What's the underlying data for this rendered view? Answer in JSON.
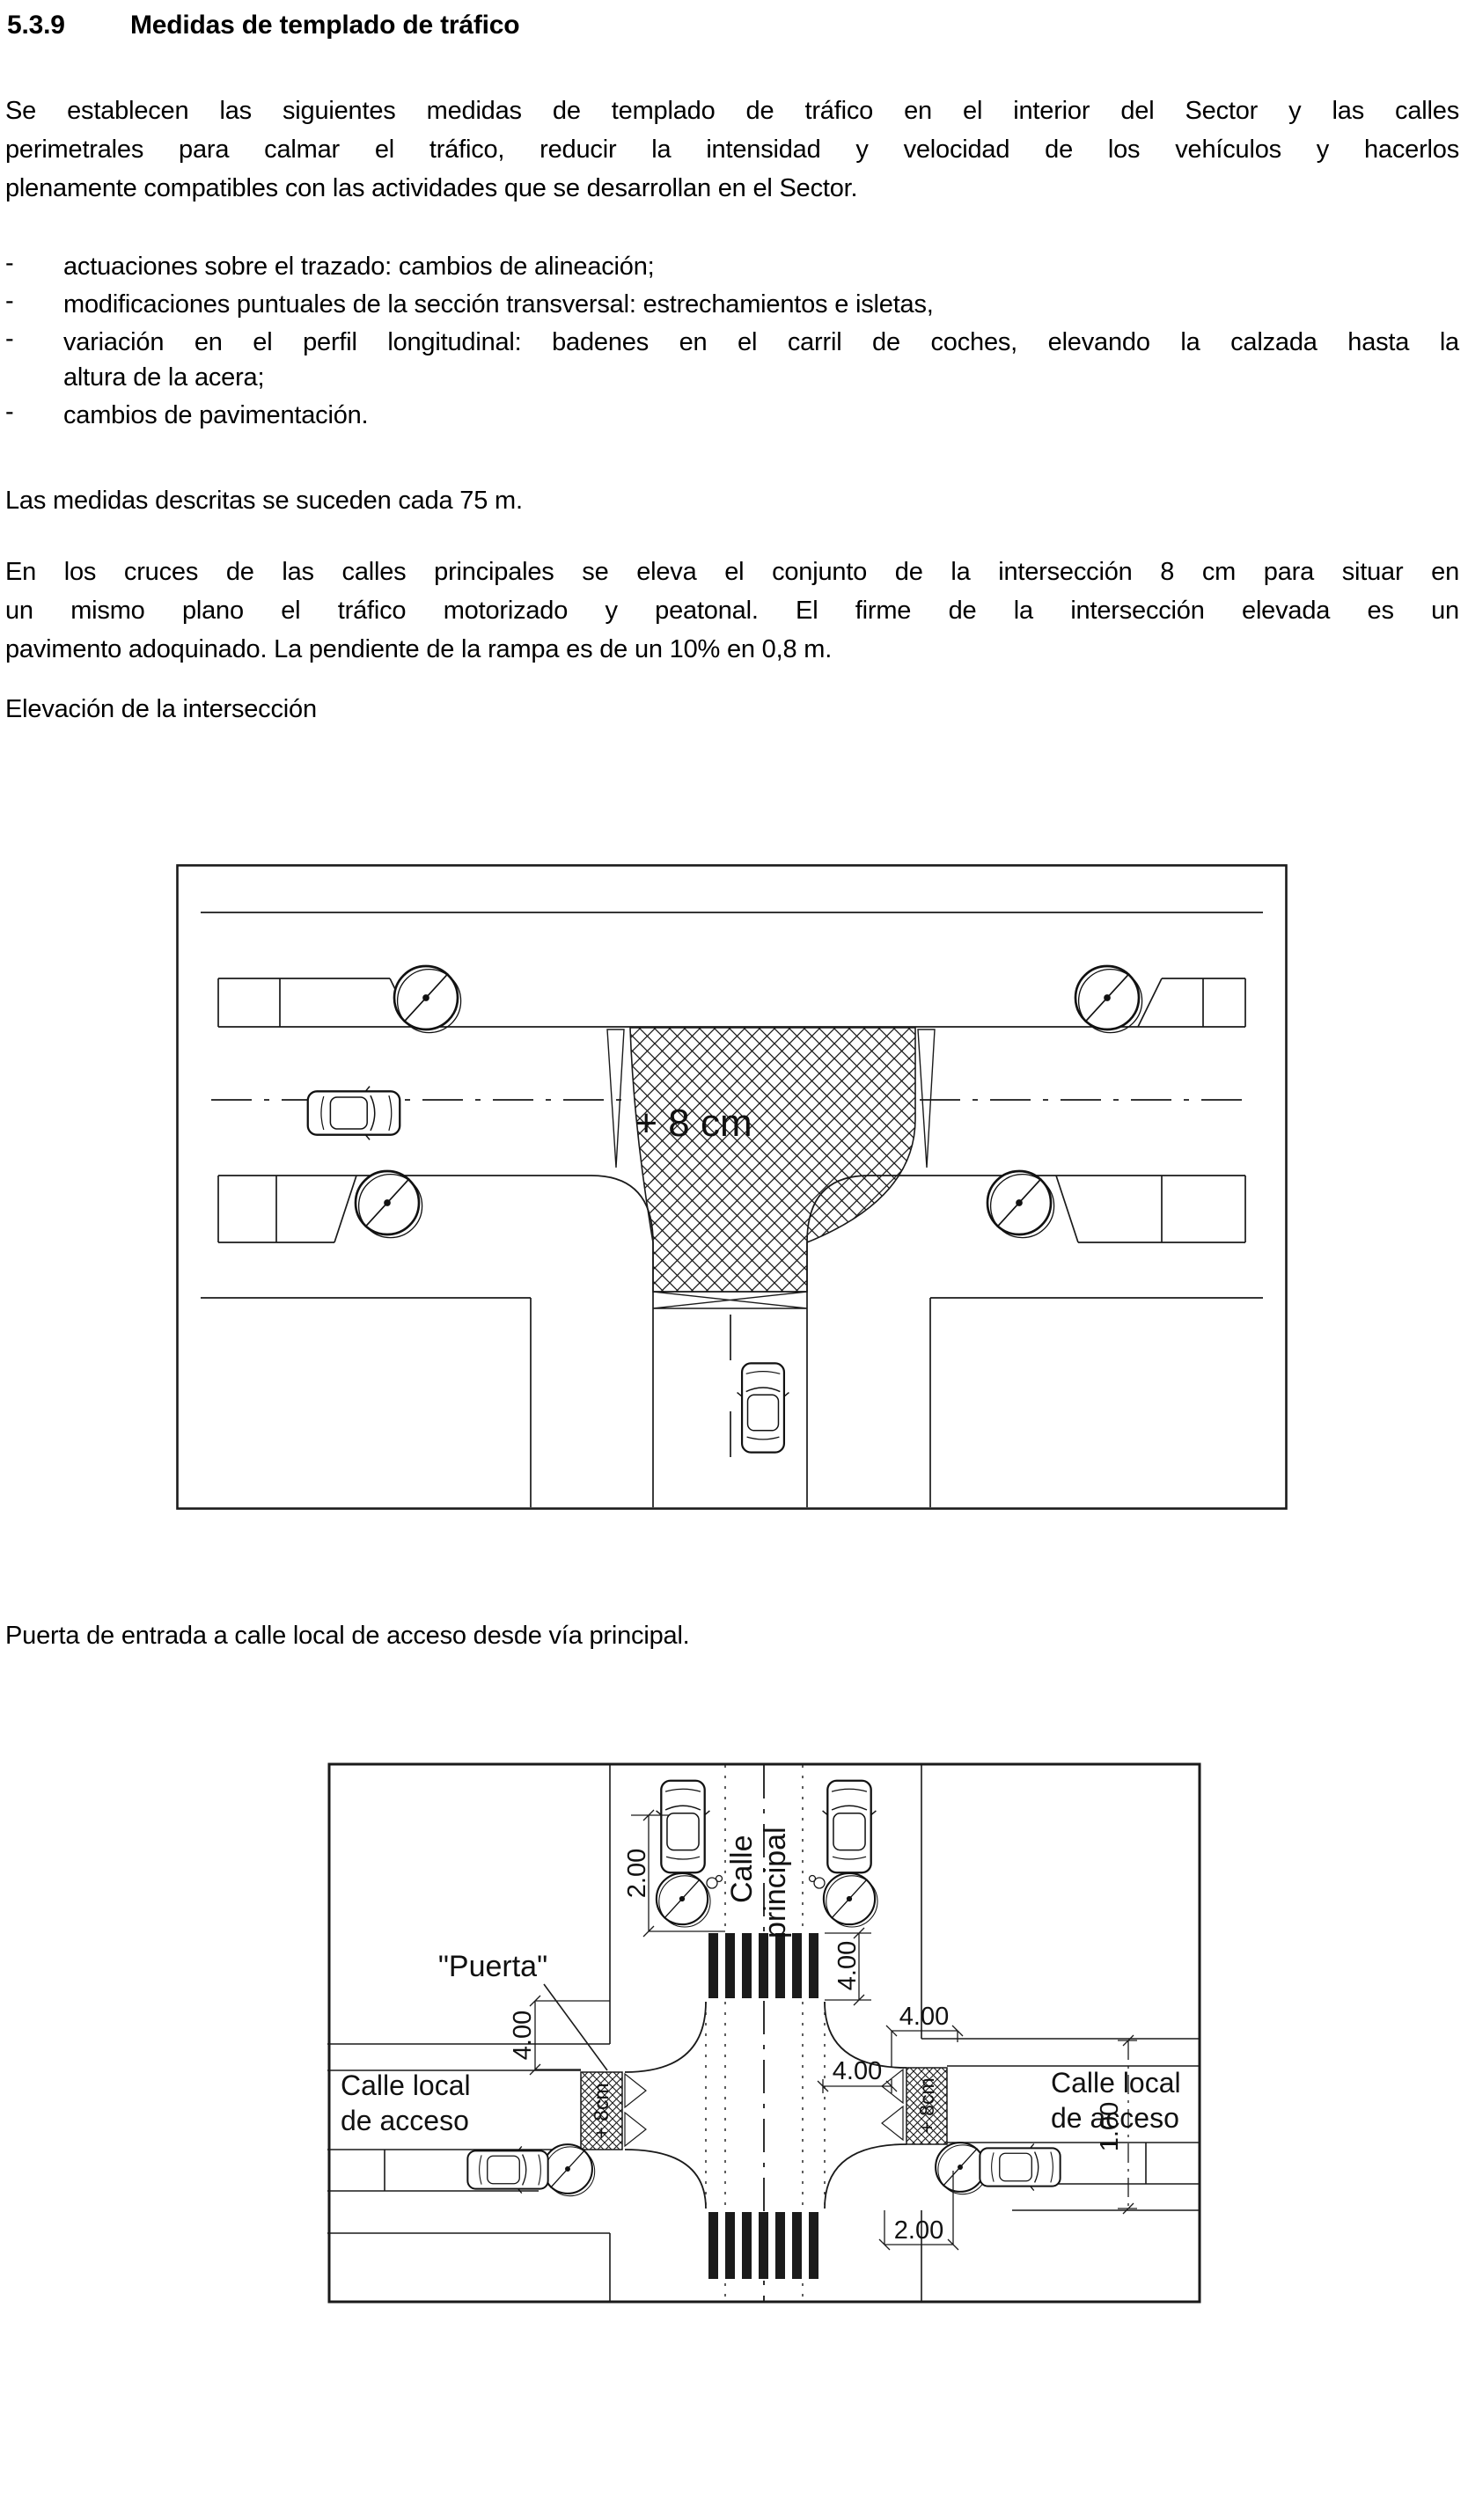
{
  "page": {
    "section_number": "5.3.9",
    "section_title": "Medidas de templado de tráfico",
    "paragraph1_lines": [
      "Se establecen las siguientes medidas de templado de tráfico en el interior del Sector y las calles",
      "perimetrales para calmar el tráfico, reducir la intensidad y velocidad de los vehículos y hacerlos",
      "plenamente compatibles con las actividades que se desarrollan en el Sector."
    ],
    "bullet_marker": "-",
    "bullets": [
      [
        "actuaciones sobre el trazado: cambios de alineación;"
      ],
      [
        "modificaciones puntuales de la sección transversal: estrechamientos e isletas,"
      ],
      [
        "variación en el perfil longitudinal: badenes en el carril de coches, elevando la calzada hasta la",
        "altura de la acera;"
      ],
      [
        "cambios de pavimentación."
      ]
    ],
    "paragraph2": "Las medidas descritas se suceden cada 75 m.",
    "paragraph3_lines": [
      "En  los  cruces  de las calles principales se eleva el conjunto de la intersección 8 cm para situar en",
      "un  mismo  plano  el  tráfico  motorizado  y  peatonal.   El  firme  de  la  intersección  elevada  es  un",
      "pavimento adoquinado.  La pendiente de la rampa es de un 10% en 0,8 m."
    ],
    "figure1_caption": "Elevación de la intersección",
    "figure2_caption": "Puerta de entrada a calle local de acceso desde vía principal."
  },
  "figure1": {
    "raised_area_label": "+ 8 cm"
  },
  "figure2": {
    "main_street_line1": "Calle",
    "main_street_line2": "principal",
    "gate_label": "\"Puerta\"",
    "local_left_line1": "Calle  local",
    "local_left_line2": "de  acceso",
    "local_right_line1": "Calle  local",
    "local_right_line2": "de  acceso",
    "gate_left_elevation": "+ 8cm",
    "gate_right_elevation": "+ 8cm",
    "dim_parking_length": "2.00",
    "dim_crosswalk_width": "4.00",
    "dim_corner_setback": "4.00",
    "dim_gate_offset": "4.00",
    "dim_gate_width": "4.00",
    "dim_bottom_parking": "2.00",
    "dim_lane_right": "1.00"
  }
}
